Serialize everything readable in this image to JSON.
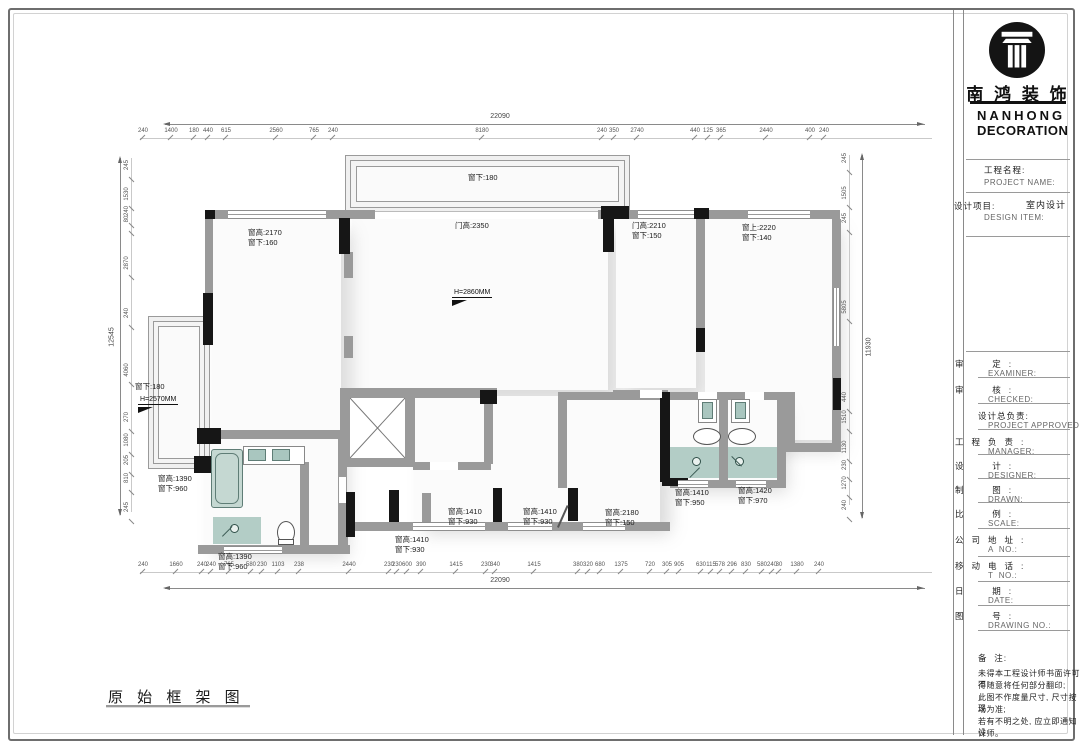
{
  "page": {
    "caption": "原 始 框 架 图"
  },
  "brand": {
    "logo_icon": "column-icon",
    "name_cn": "南 鸿 装 饰",
    "name_en_1": "NANHONG",
    "name_en_2": "DECORATION"
  },
  "titleblock": {
    "project_cn": "工程名程:",
    "project_en": "PROJECT NAME:",
    "design_cn": "设计项目:",
    "design_en": "DESIGN ITEM:",
    "design_value": "室内设计",
    "rows": [
      {
        "cn": "审  定:",
        "en": "EXAMINER:"
      },
      {
        "cn": "审  核:",
        "en": "CHECKED:"
      },
      {
        "cn": "设计总负责:",
        "en": "PROJECT APPROVED:"
      },
      {
        "cn": "工程负责:",
        "en": "MANAGER:"
      },
      {
        "cn": "设  计:",
        "en": "DESIGNER:"
      },
      {
        "cn": "制  图:",
        "en": "DRAWN:"
      },
      {
        "cn": "比  例:",
        "en": "SCALE:"
      },
      {
        "cn": "公司地址:",
        "en": "A  NO.:"
      },
      {
        "cn": "移动电话:",
        "en": "T  NO.:"
      },
      {
        "cn": "日  期:",
        "en": "DATE:"
      },
      {
        "cn": "图  号:",
        "en": "DRAWING NO.:"
      }
    ],
    "remark_cn": "备  注:",
    "remark_lines": [
      "未得本工程设计师书面许可不",
      "得随意将任何部分翻印;",
      "此图不作度量尺寸, 尺寸按现",
      "场为准;",
      "若有不明之处, 应立即通知设",
      "计师。"
    ]
  },
  "plan": {
    "labels": [
      {
        "t": "窗下:180",
        "x": 468,
        "y": 173
      },
      {
        "t": "窗高:2170\n窗下:160",
        "x": 248,
        "y": 228
      },
      {
        "t": "门高:2350",
        "x": 455,
        "y": 221
      },
      {
        "t": "门高:2210\n窗下:150",
        "x": 632,
        "y": 221
      },
      {
        "t": "窗上:2220\n窗下:140",
        "x": 742,
        "y": 223
      },
      {
        "t": "窗下:180",
        "x": 135,
        "y": 382
      },
      {
        "t": "窗高:1390\n窗下:960",
        "x": 158,
        "y": 474
      },
      {
        "t": "窗高:1390\n窗下:960",
        "x": 218,
        "y": 552
      },
      {
        "t": "窗高:1410\n窗下:930",
        "x": 395,
        "y": 535
      },
      {
        "t": "窗高:1410\n窗下:930",
        "x": 448,
        "y": 507
      },
      {
        "t": "窗高:1410\n窗下:930",
        "x": 523,
        "y": 507
      },
      {
        "t": "窗高:2180\n窗下:150",
        "x": 605,
        "y": 508
      },
      {
        "t": "窗高:1410\n窗下:950",
        "x": 675,
        "y": 488
      },
      {
        "t": "窗高:1420\n窗下:970",
        "x": 738,
        "y": 486
      }
    ],
    "height_markers": [
      {
        "t": "H=2860MM",
        "x": 452,
        "y": 289
      },
      {
        "t": "H=2570MM",
        "x": 138,
        "y": 396
      }
    ]
  },
  "dimensions": {
    "top": {
      "total": "22090",
      "segments": [
        {
          "v": "240",
          "x": 143
        },
        {
          "v": "1400",
          "x": 171
        },
        {
          "v": "180",
          "x": 194
        },
        {
          "v": "440",
          "x": 208
        },
        {
          "v": "615",
          "x": 226
        },
        {
          "v": "2560",
          "x": 276
        },
        {
          "v": "765",
          "x": 314
        },
        {
          "v": "240",
          "x": 333
        },
        {
          "v": "8180",
          "x": 482
        },
        {
          "v": "240",
          "x": 602
        },
        {
          "v": "350",
          "x": 614
        },
        {
          "v": "2740",
          "x": 637
        },
        {
          "v": "440",
          "x": 695
        },
        {
          "v": "125",
          "x": 708
        },
        {
          "v": "365",
          "x": 721
        },
        {
          "v": "2440",
          "x": 766
        },
        {
          "v": "400",
          "x": 810
        },
        {
          "v": "240",
          "x": 824
        }
      ]
    },
    "bottom": {
      "total": "22090",
      "segments": [
        {
          "v": "240",
          "x": 143
        },
        {
          "v": "1660",
          "x": 176
        },
        {
          "v": "240",
          "x": 202
        },
        {
          "v": "240",
          "x": 211
        },
        {
          "v": "765",
          "x": 229
        },
        {
          "v": "580",
          "x": 251
        },
        {
          "v": "230",
          "x": 262
        },
        {
          "v": "1103",
          "x": 278
        },
        {
          "v": "238",
          "x": 299
        },
        {
          "v": "2440",
          "x": 349
        },
        {
          "v": "230",
          "x": 389
        },
        {
          "v": "230",
          "x": 397
        },
        {
          "v": "600",
          "x": 407
        },
        {
          "v": "390",
          "x": 421
        },
        {
          "v": "1415",
          "x": 456
        },
        {
          "v": "230",
          "x": 486
        },
        {
          "v": "340",
          "x": 495
        },
        {
          "v": "1415",
          "x": 534
        },
        {
          "v": "380",
          "x": 578
        },
        {
          "v": "320",
          "x": 588
        },
        {
          "v": "680",
          "x": 600
        },
        {
          "v": "1375",
          "x": 621
        },
        {
          "v": "720",
          "x": 650
        },
        {
          "v": "305",
          "x": 667
        },
        {
          "v": "905",
          "x": 679
        },
        {
          "v": "630",
          "x": 701
        },
        {
          "v": "115",
          "x": 711
        },
        {
          "v": "578",
          "x": 720
        },
        {
          "v": "296",
          "x": 732
        },
        {
          "v": "830",
          "x": 746
        },
        {
          "v": "580",
          "x": 762
        },
        {
          "v": "240",
          "x": 772
        },
        {
          "v": "30",
          "x": 779
        },
        {
          "v": "1380",
          "x": 797
        },
        {
          "v": "240",
          "x": 819
        }
      ]
    },
    "left": {
      "total": "12545",
      "segments": [
        {
          "v": "245",
          "y": 165
        },
        {
          "v": "1530",
          "y": 194
        },
        {
          "v": "240",
          "y": 211
        },
        {
          "v": "80",
          "y": 219
        },
        {
          "v": "2870",
          "y": 263
        },
        {
          "v": "240",
          "y": 313
        },
        {
          "v": "4060",
          "y": 370
        },
        {
          "v": "270",
          "y": 417
        },
        {
          "v": "1080",
          "y": 440
        },
        {
          "v": "205",
          "y": 460
        },
        {
          "v": "810",
          "y": 478
        },
        {
          "v": "245",
          "y": 507
        }
      ]
    },
    "right": {
      "total": "11930",
      "segments": [
        {
          "v": "245",
          "y": 158
        },
        {
          "v": "1505",
          "y": 193
        },
        {
          "v": "245",
          "y": 218
        },
        {
          "v": "5805",
          "y": 307
        },
        {
          "v": "440",
          "y": 397
        },
        {
          "v": "1510",
          "y": 417
        },
        {
          "v": "1130",
          "y": 447
        },
        {
          "v": "230",
          "y": 465
        },
        {
          "v": "1270",
          "y": 483
        },
        {
          "v": "240",
          "y": 505
        }
      ]
    }
  }
}
